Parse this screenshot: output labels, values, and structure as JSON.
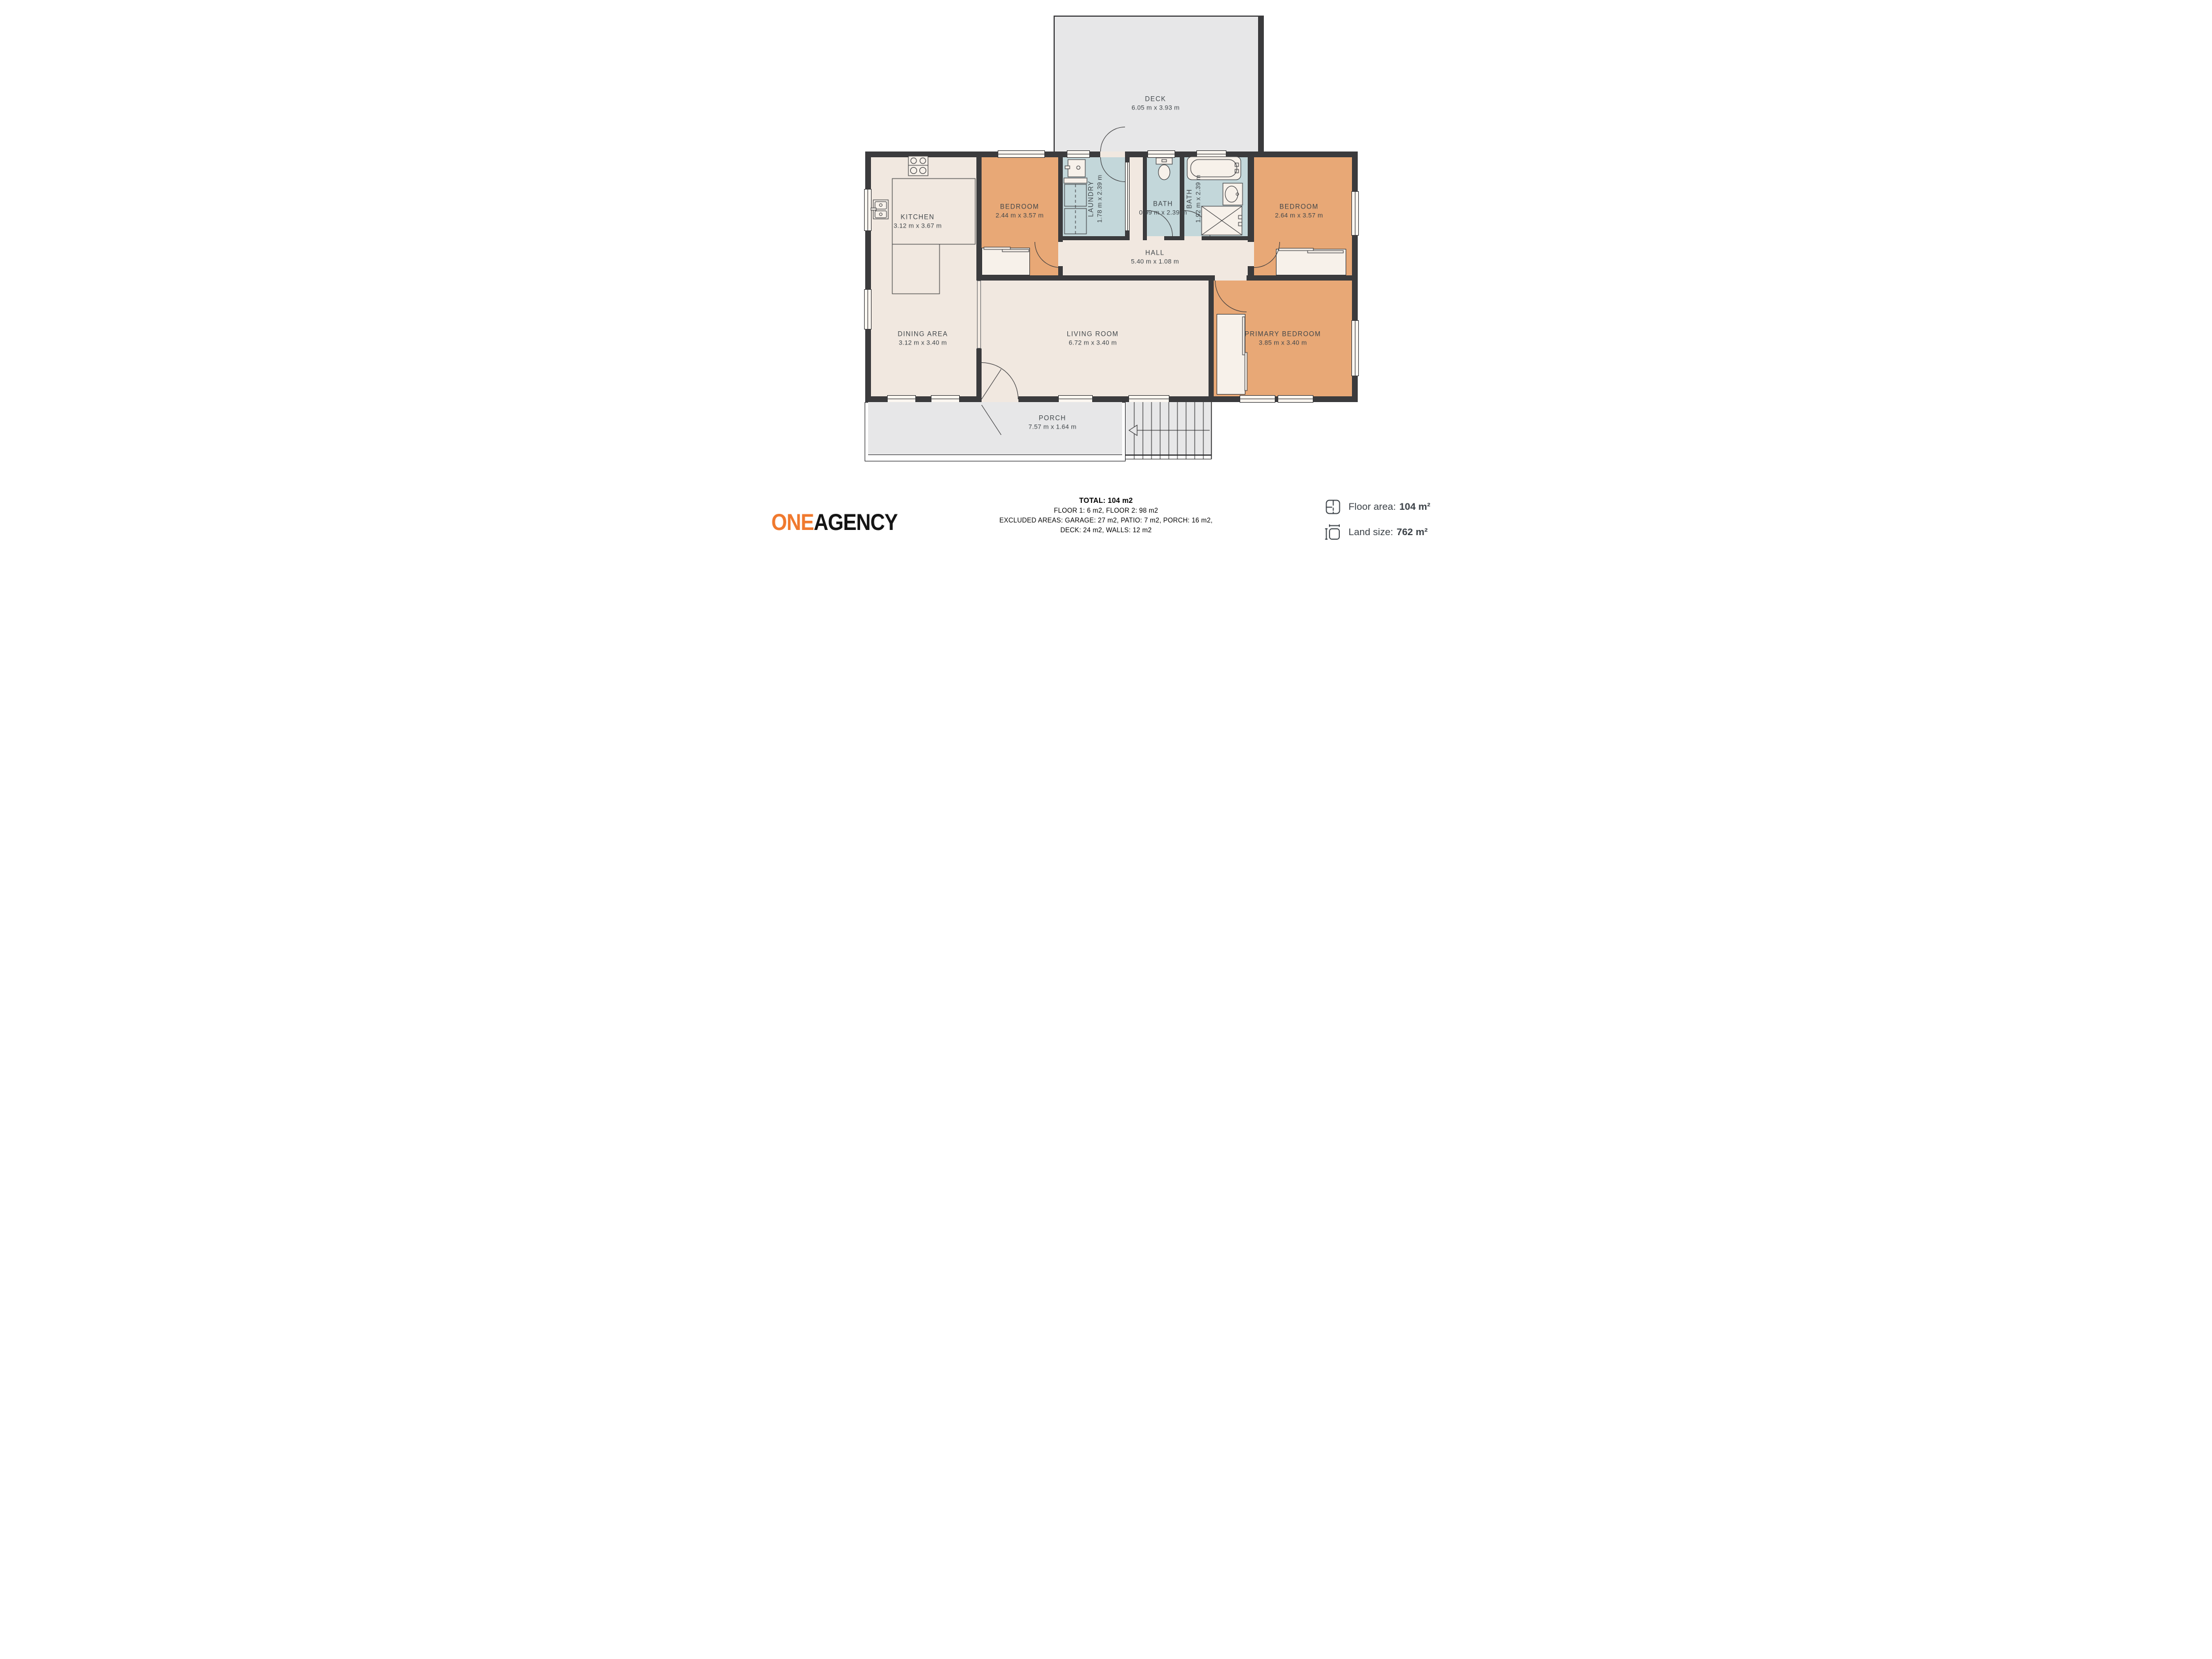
{
  "plan": {
    "deck": {
      "name": "DECK",
      "dims": "6.05 m x 3.93 m"
    },
    "kitchen": {
      "name": "KITCHEN",
      "dims": "3.12 m x 3.67 m"
    },
    "bedroom_left": {
      "name": "BEDROOM",
      "dims": "2.44 m x 3.57 m"
    },
    "laundry": {
      "name": "LAUNDRY",
      "dims": "1.78 m x 2.39 m"
    },
    "bath_small": {
      "name": "BATH",
      "dims": "0.99 m x 2.39 m"
    },
    "bath_main": {
      "name": "BATH",
      "dims": "1.92 m x 2.39 m"
    },
    "bedroom_right": {
      "name": "BEDROOM",
      "dims": "2.64 m x 3.57 m"
    },
    "hall": {
      "name": "HALL",
      "dims": "5.40 m x 1.08 m"
    },
    "dining": {
      "name": "DINING AREA",
      "dims": "3.12 m x 3.40 m"
    },
    "living": {
      "name": "LIVING ROOM",
      "dims": "6.72 m x 3.40 m"
    },
    "primary_bedroom": {
      "name": "PRIMARY BEDROOM",
      "dims": "3.85 m x 3.40 m"
    },
    "porch": {
      "name": "PORCH",
      "dims": "7.57 m x 1.64 m"
    }
  },
  "summary": {
    "total": "TOTAL: 104 m2",
    "floors": "FLOOR 1: 6 m2, FLOOR 2: 98 m2",
    "excluded_line1": "EXCLUDED AREAS: GARAGE: 27 m2, PATIO: 7 m2, PORCH: 16 m2,",
    "excluded_line2": "DECK: 24 m2, WALLS: 12 m2",
    "disclaimer": "MEASUREMENTS DEEMED HIGHLY RELIABLE BUT NOT GUARANTEED."
  },
  "branding": {
    "logo_one": "ONE",
    "logo_agency": "AGENCY"
  },
  "stats": {
    "floor_area_label": "Floor area:",
    "floor_area_value": "104 m²",
    "land_size_label": "Land size:",
    "land_size_value": "762 m²"
  },
  "colors": {
    "wall": "#3B3B3D",
    "floor": "#F1E8E0",
    "bedroom": "#E8A876",
    "wet_room": "#C3D7DA",
    "outdoor": "#E7E7E8",
    "logo_orange": "#F0792E",
    "label_text": "#3F4549"
  }
}
